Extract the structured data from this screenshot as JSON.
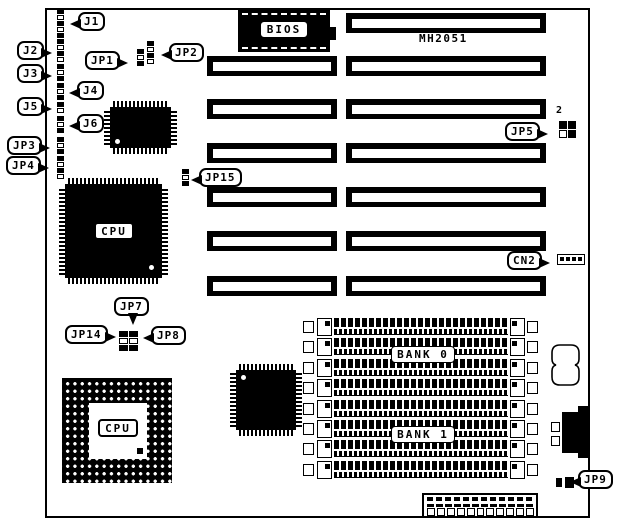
{
  "board": {
    "model": "MH2051"
  },
  "callouts": {
    "j1": "J1",
    "j2": "J2",
    "j3": "J3",
    "j4": "J4",
    "j5": "J5",
    "j6": "J6",
    "jp1": "JP1",
    "jp2": "JP2",
    "jp3": "JP3",
    "jp4": "JP4",
    "jp5": "JP5",
    "jp7": "JP7",
    "jp8": "JP8",
    "jp9": "JP9",
    "jp14": "JP14",
    "jp15": "JP15",
    "cn2": "CN2"
  },
  "chips": {
    "bios": "BIOS",
    "cpu_qfp": "CPU",
    "cpu_pga": "CPU"
  },
  "memory": {
    "bank0": "BANK 0",
    "bank1": "BANK 1",
    "simm_row_count": 8
  },
  "slots": {
    "left_count": 6,
    "right_count": 7
  },
  "jp5_pin_label": "2",
  "colors": {
    "ink": "#000000",
    "paper": "#ffffff"
  }
}
